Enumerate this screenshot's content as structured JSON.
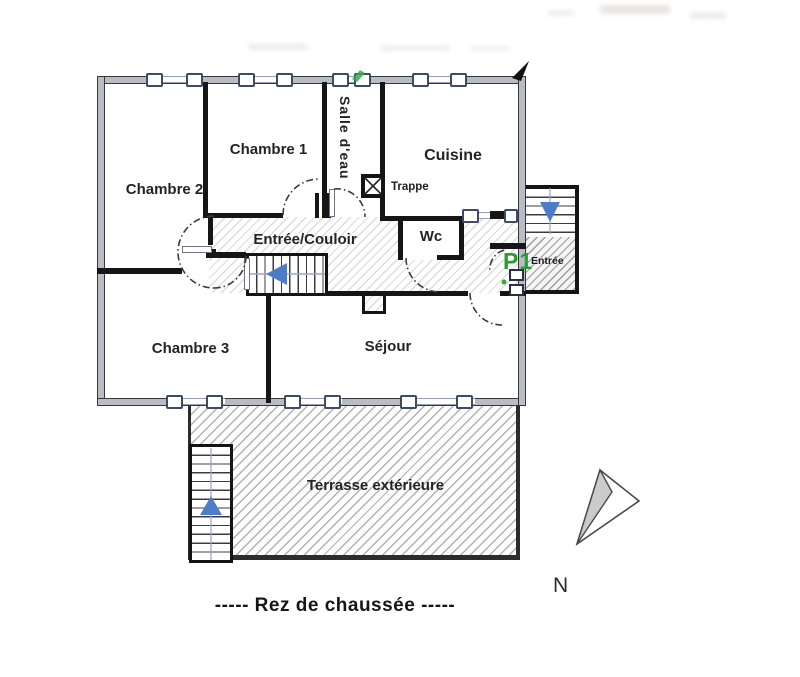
{
  "plan": {
    "caption": "-----   Rez de chaussée   -----",
    "compass_label": "N",
    "rooms": {
      "chambre1": "Chambre 1",
      "chambre2": "Chambre 2",
      "chambre3": "Chambre 3",
      "salle_eau": "Salle d'eau",
      "cuisine": "Cuisine",
      "entree_couloir": "Entrée/Couloir",
      "wc": "Wc",
      "sejour": "Séjour",
      "terrasse": "Terrasse extérieure"
    },
    "annotations": {
      "trappe": "Trappe",
      "parking": "P1",
      "entree": "Entrée"
    },
    "colors": {
      "p1_green": "#22a12e",
      "stair_arrow_blue": "#4d7dc8",
      "wall_black": "#161616",
      "wall_gray_fill": "#b9bdc3",
      "window_frame": "#3d4c66",
      "hatch_light": "#dcdcdc",
      "hatch_medium": "#9e9e9e"
    }
  }
}
